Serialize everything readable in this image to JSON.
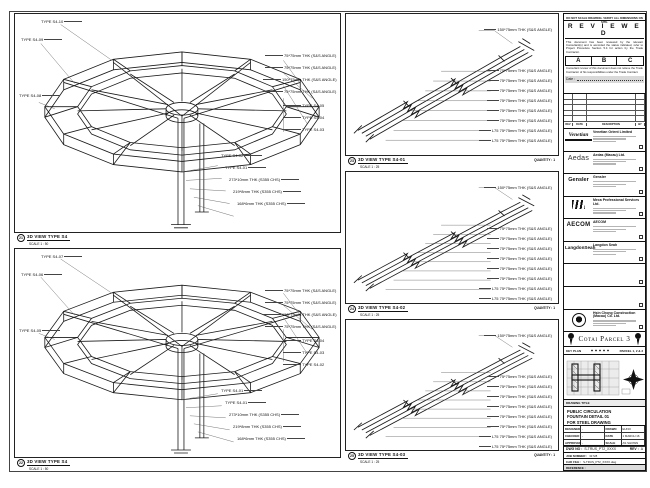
{
  "sheet_note": "DO NOT SCALE DRAWING. VERIFY ALL DIMENSIONS ON SITE.",
  "stamp": {
    "title": "R E V I E W E D",
    "para1": "This document has been reviewed by the relevant Consultant(s) and is accorded the status indicated, refer to Project Procedure Section 5.4 for action by the Trade Contractor.",
    "grades": [
      "A",
      "B",
      "C"
    ],
    "para2": "Consultant review of this document does not relieve the Trade Contractor of his responsibilities under the Trade Contract.",
    "date_label": "Date :"
  },
  "revisions": {
    "headers": [
      "REV",
      "DATE",
      "DESCRIPTION",
      "BY"
    ]
  },
  "companies": [
    {
      "logo_text": "Venetian",
      "name": "Venetian Orient Limited",
      "cls": "logo-venetian"
    },
    {
      "logo_text": "Aedas",
      "name": "Aedas (Macau) Ltd.",
      "cls": "logo-aedas"
    },
    {
      "logo_text": "Gensler",
      "name": "Gensler",
      "cls": "logo-gensler"
    },
    {
      "logo_text": "",
      "name": "Meca Professional Services Ltd.",
      "cls": "logo-mps"
    },
    {
      "logo_text": "AECOM",
      "name": "AECOM",
      "cls": "logo-aecom"
    },
    {
      "logo_text": "LangdonSeah",
      "name": "Langdon Seah",
      "cls": "logo-ls"
    },
    {
      "logo_text": "",
      "name": "",
      "cls": "empty"
    },
    {
      "logo_text": "",
      "name": "",
      "cls": "empty"
    },
    {
      "logo_text": "",
      "name": "Hsin Chong Construction (Macau) Co. Ltd.",
      "cls": "logo-hc"
    }
  ],
  "project": {
    "banner": "Cotai Parcel 3",
    "key_plan": "KEY PLAN",
    "parcel": "PARCEL 1, 2 & 3"
  },
  "titleblock": {
    "drawing_title_label": "DRAWING TITLE",
    "title_lines": [
      "PUBLIC CIRCULATION",
      "FOUNTAIN DETAIL 01",
      "FOR STEEL DRAWING"
    ],
    "fields": [
      {
        "label": "DESIGNED",
        "value": "-"
      },
      {
        "label": "DRAWN",
        "value": "EUNO"
      },
      {
        "label": "CHECKED",
        "value": "-"
      },
      {
        "label": "DATE",
        "value": "1 MARCH 16"
      },
      {
        "label": "APPROVED",
        "value": "-"
      },
      {
        "label": "SCALE",
        "value": "AS SHOWN"
      }
    ],
    "dwg_label": "DWG NO :",
    "dwg_no": "S-TRUS_PT2_XXXX",
    "rev_label": "REV :",
    "rev": "A",
    "job_label": "JOB NUMBER :",
    "job_no": "31728",
    "cad_label": "CAD FILE :",
    "cad_file": "S-TRUS_PT2_XXXX.dwg",
    "ref_label": "REFERENCE :"
  },
  "panels": [
    {
      "bubble": "21",
      "title": "3D VIEW TYPE S4",
      "scale": "SCALE 1 : 50",
      "quantity": "",
      "labels": [
        {
          "x": 26,
          "y": 6,
          "text": "TYPE S4-10",
          "cls": "al"
        },
        {
          "x": 6,
          "y": 24,
          "text": "TYPE S4-09",
          "cls": "al"
        },
        {
          "x": 4,
          "y": 80,
          "text": "TYPE S4-08",
          "cls": "al"
        },
        {
          "x": 250,
          "y": 40,
          "text": "75*75mm THK (S&S ANGLE)",
          "cls": "ar"
        },
        {
          "x": 250,
          "y": 52,
          "text": "75*75mm THK (S&S ANGLE)",
          "cls": "ar"
        },
        {
          "x": 248,
          "y": 64,
          "text": "150*75mm THK (S&S ANGLE)",
          "cls": "ar"
        },
        {
          "x": 250,
          "y": 76,
          "text": "75*75mm THK (S&S ANGLE)",
          "cls": "ar"
        },
        {
          "x": 268,
          "y": 90,
          "text": "TYPE S4-05",
          "cls": "ar"
        },
        {
          "x": 268,
          "y": 102,
          "text": "TYPE S4-04",
          "cls": "ar"
        },
        {
          "x": 268,
          "y": 114,
          "text": "TYPE S4-03",
          "cls": "ar"
        },
        {
          "x": 206,
          "y": 140,
          "text": "TYPE S4-02",
          "cls": "al"
        },
        {
          "x": 210,
          "y": 152,
          "text": "TYPE S4-01",
          "cls": "al"
        },
        {
          "x": 214,
          "y": 164,
          "text": "273*10mm THK (S355 CHS)",
          "cls": "al"
        },
        {
          "x": 218,
          "y": 176,
          "text": "219*8mm THK (S355 CHS)",
          "cls": "al"
        },
        {
          "x": 222,
          "y": 188,
          "text": "168*6mm THK (S355 CHS)",
          "cls": "al"
        }
      ]
    },
    {
      "bubble": "22",
      "title": "3D VIEW TYPE S4",
      "scale": "SCALE 1 : 50",
      "quantity": "",
      "labels": [
        {
          "x": 26,
          "y": 6,
          "text": "TYPE S4-07",
          "cls": "al"
        },
        {
          "x": 6,
          "y": 24,
          "text": "TYPE S4-06",
          "cls": "al"
        },
        {
          "x": 4,
          "y": 80,
          "text": "TYPE S4-05",
          "cls": "al"
        },
        {
          "x": 250,
          "y": 40,
          "text": "75*75mm THK (S&S ANGLE)",
          "cls": "ar"
        },
        {
          "x": 250,
          "y": 52,
          "text": "75*75mm THK (S&S ANGLE)",
          "cls": "ar"
        },
        {
          "x": 248,
          "y": 64,
          "text": "150*75mm THK (S&S ANGLE)",
          "cls": "ar"
        },
        {
          "x": 250,
          "y": 76,
          "text": "75*75mm THK (S&S ANGLE)",
          "cls": "ar"
        },
        {
          "x": 268,
          "y": 90,
          "text": "TYPE S4-04",
          "cls": "ar"
        },
        {
          "x": 268,
          "y": 102,
          "text": "TYPE S4-03",
          "cls": "ar"
        },
        {
          "x": 268,
          "y": 114,
          "text": "TYPE S4-02",
          "cls": "ar"
        },
        {
          "x": 206,
          "y": 140,
          "text": "TYPE S4-01",
          "cls": "al"
        },
        {
          "x": 210,
          "y": 152,
          "text": "TYPE S4-01",
          "cls": "al"
        },
        {
          "x": 214,
          "y": 164,
          "text": "273*10mm THK (S355 CHS)",
          "cls": "al"
        },
        {
          "x": 218,
          "y": 176,
          "text": "219*8mm THK (S355 CHS)",
          "cls": "al"
        },
        {
          "x": 222,
          "y": 188,
          "text": "168*6mm THK (S355 CHS)",
          "cls": "al"
        }
      ]
    },
    {
      "bubble": "23",
      "title": "3D VIEW TYPE S4-01",
      "scale": "SCALE 1 : 25",
      "quantity": "QUANTITY : 1",
      "labels": [
        {
          "x": 120,
          "y": 14,
          "text": "150*75mm THK (S&S ANGLE)",
          "cls": "ar2"
        },
        {
          "x": 120,
          "y": 55,
          "text": "75*75mm THK (S&S ANGLE)",
          "cls": "ar2"
        },
        {
          "x": 120,
          "y": 65,
          "text": "75*75mm THK (S&S ANGLE)",
          "cls": "ar2"
        },
        {
          "x": 120,
          "y": 75,
          "text": "75*75mm THK (S&S ANGLE)",
          "cls": "ar2"
        },
        {
          "x": 120,
          "y": 85,
          "text": "75*75mm THK (S&S ANGLE)",
          "cls": "ar2"
        },
        {
          "x": 120,
          "y": 95,
          "text": "75*75mm THK (S&S ANGLE)",
          "cls": "ar2"
        },
        {
          "x": 120,
          "y": 105,
          "text": "75*75mm THK (S&S ANGLE)",
          "cls": "ar2"
        },
        {
          "x": 120,
          "y": 115,
          "text": "L75 75*75mm THK (S&S ANGLE)",
          "cls": "ar2"
        },
        {
          "x": 120,
          "y": 125,
          "text": "L75 75*75mm THK (S&S ANGLE)",
          "cls": "ar2"
        }
      ]
    },
    {
      "bubble": "24",
      "title": "3D VIEW TYPE S4-02",
      "scale": "SCALE 1 : 25",
      "quantity": "QUANTITY : 1",
      "labels": [
        {
          "x": 120,
          "y": 14,
          "text": "150*75mm THK (S&S ANGLE)",
          "cls": "ar2"
        },
        {
          "x": 120,
          "y": 55,
          "text": "75*75mm THK (S&S ANGLE)",
          "cls": "ar2"
        },
        {
          "x": 120,
          "y": 65,
          "text": "75*75mm THK (S&S ANGLE)",
          "cls": "ar2"
        },
        {
          "x": 120,
          "y": 75,
          "text": "75*75mm THK (S&S ANGLE)",
          "cls": "ar2"
        },
        {
          "x": 120,
          "y": 85,
          "text": "75*75mm THK (S&S ANGLE)",
          "cls": "ar2"
        },
        {
          "x": 120,
          "y": 95,
          "text": "75*75mm THK (S&S ANGLE)",
          "cls": "ar2"
        },
        {
          "x": 120,
          "y": 105,
          "text": "75*75mm THK (S&S ANGLE)",
          "cls": "ar2"
        },
        {
          "x": 120,
          "y": 115,
          "text": "L75 75*75mm THK (S&S ANGLE)",
          "cls": "ar2"
        },
        {
          "x": 120,
          "y": 125,
          "text": "L75 75*75mm THK (S&S ANGLE)",
          "cls": "ar2"
        }
      ]
    },
    {
      "bubble": "25",
      "title": "3D VIEW TYPE S4-03",
      "scale": "SCALE 1 : 25",
      "quantity": "QUANTITY : 1",
      "labels": [
        {
          "x": 120,
          "y": 14,
          "text": "150*75mm THK (S&S ANGLE)",
          "cls": "ar2"
        },
        {
          "x": 120,
          "y": 55,
          "text": "75*75mm THK (S&S ANGLE)",
          "cls": "ar2"
        },
        {
          "x": 120,
          "y": 65,
          "text": "75*75mm THK (S&S ANGLE)",
          "cls": "ar2"
        },
        {
          "x": 120,
          "y": 75,
          "text": "75*75mm THK (S&S ANGLE)",
          "cls": "ar2"
        },
        {
          "x": 120,
          "y": 85,
          "text": "75*75mm THK (S&S ANGLE)",
          "cls": "ar2"
        },
        {
          "x": 120,
          "y": 95,
          "text": "75*75mm THK (S&S ANGLE)",
          "cls": "ar2"
        },
        {
          "x": 120,
          "y": 105,
          "text": "75*75mm THK (S&S ANGLE)",
          "cls": "ar2"
        },
        {
          "x": 120,
          "y": 115,
          "text": "L75 75*75mm THK (S&S ANGLE)",
          "cls": "ar2"
        },
        {
          "x": 120,
          "y": 125,
          "text": "L75 75*75mm THK (S&S ANGLE)",
          "cls": "ar2"
        }
      ]
    }
  ]
}
